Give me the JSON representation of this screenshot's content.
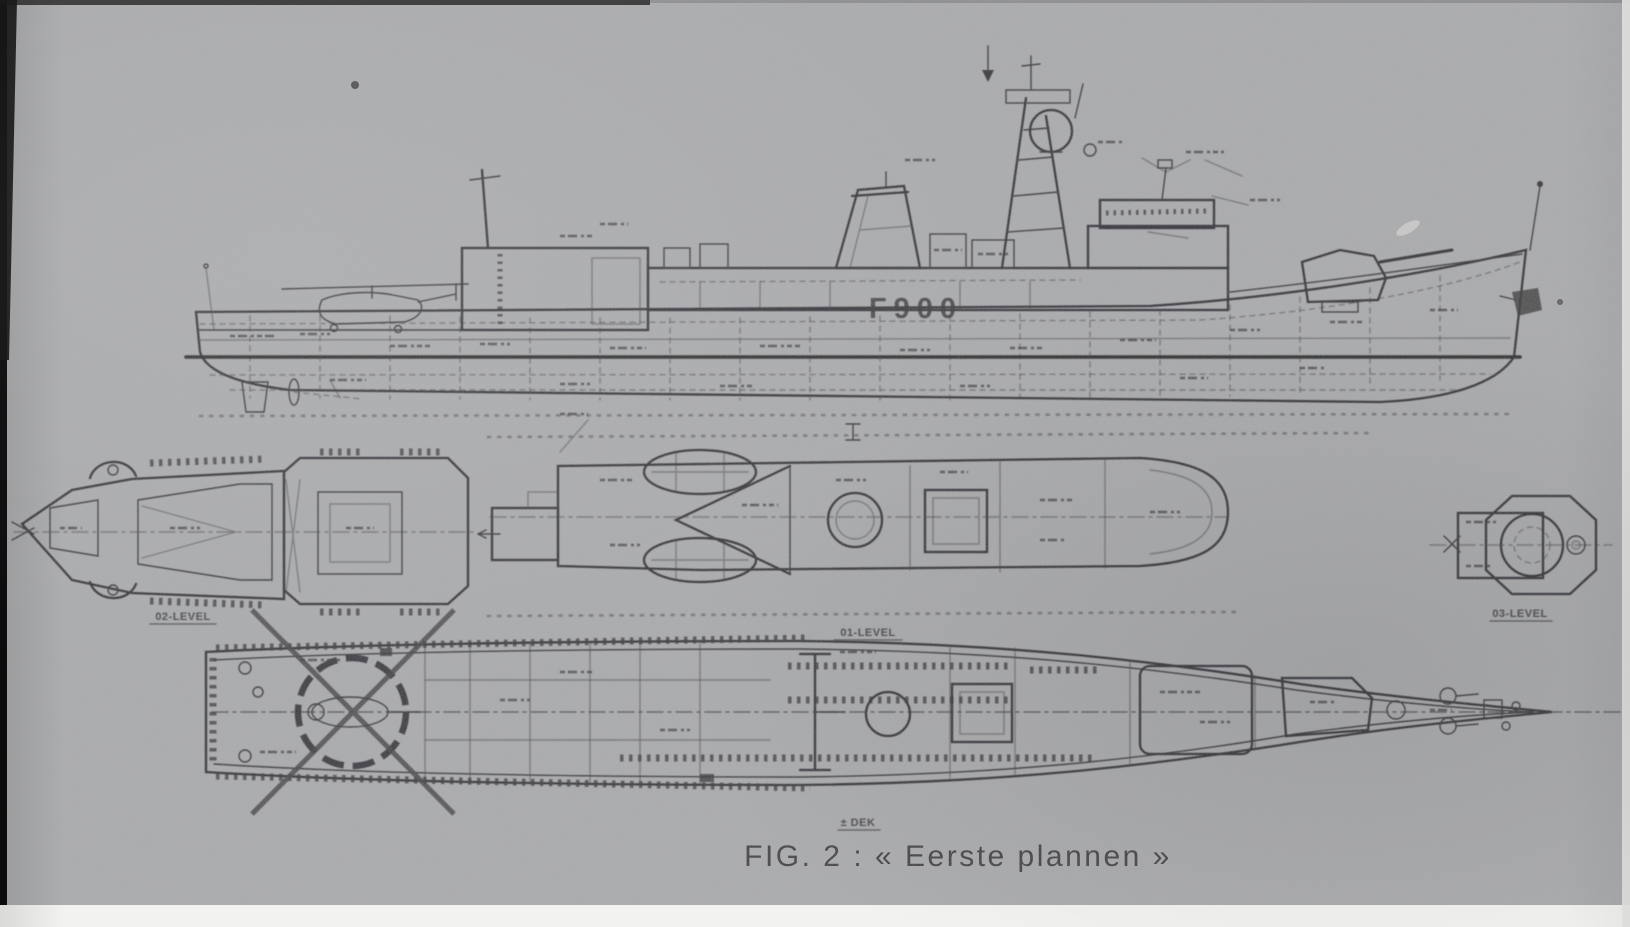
{
  "figure": {
    "caption": "FIG. 2 : « Eerste plannen »"
  },
  "ship": {
    "hull_number": "F900"
  },
  "plan_labels": {
    "level_02": "02-LEVEL",
    "level_01": "01-LEVEL",
    "level_03": "03-LEVEL",
    "main_deck": "± DEK"
  },
  "colors": {
    "paper": "#a5a6a8",
    "ink": "#222226",
    "edge_black": "#0c0c0c",
    "margin_white": "#f2f2f0"
  }
}
